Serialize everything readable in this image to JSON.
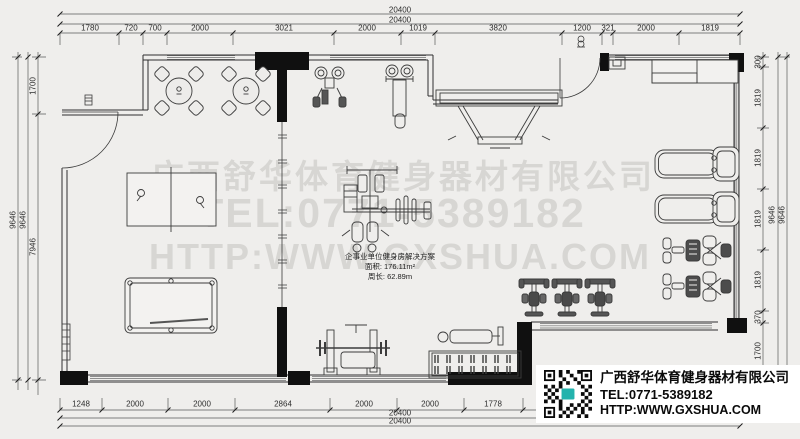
{
  "watermark": {
    "company": "广西舒华体育健身器材有限公司",
    "tel": "TEL:0771-5389182",
    "website": "HTTP:WWW.GXSHUA.COM"
  },
  "plan_label": {
    "title": "企事业单位健身房解决方案",
    "area": "面积: 176.11m²",
    "perimeter": "周长: 62.89m"
  },
  "dimensions": {
    "top": {
      "total_outer": "20400",
      "total_inner": "20400",
      "segments": [
        "1780",
        "720",
        "700",
        "2000",
        "3021",
        "2000",
        "1019",
        "3820",
        "1200",
        "321",
        "2000",
        "1819"
      ]
    },
    "bottom": {
      "segments": [
        "1248",
        "2000",
        "2000",
        "2864",
        "2000",
        "2000",
        "1778"
      ],
      "total_inner": "20400",
      "total_outer": "20400"
    },
    "left": {
      "total_outer": "9646",
      "total_inner": "9646",
      "segments": [
        "1700",
        "7946"
      ]
    },
    "right": {
      "segments": [
        "300",
        "1819",
        "1819",
        "1819",
        "1819",
        "370",
        "1700"
      ],
      "total_inner": "9646",
      "total_outer": "9646"
    }
  },
  "info_card": {
    "company": "广西舒华体育健身器材有限公司",
    "tel": "TEL:0771-5389182",
    "website": "HTTP:WWW.GXSHUA.COM",
    "qr_center_color": "#23b3ad"
  },
  "equipment": [
    "round-table-with-chairs",
    "round-table-with-chairs",
    "table-tennis-table",
    "billiard-table",
    "multi-station-gym",
    "shoulder-press-machine",
    "lat-pulldown-machine",
    "wall-mounted-rack-frame",
    "storage-counter",
    "wall-cabinet",
    "treadmill",
    "treadmill",
    "elliptical-trainer",
    "elliptical-trainer",
    "spin-bike",
    "spin-bike",
    "spin-bike",
    "bench-press-station",
    "flat-bench",
    "dumbbell-rack",
    "radiator"
  ]
}
